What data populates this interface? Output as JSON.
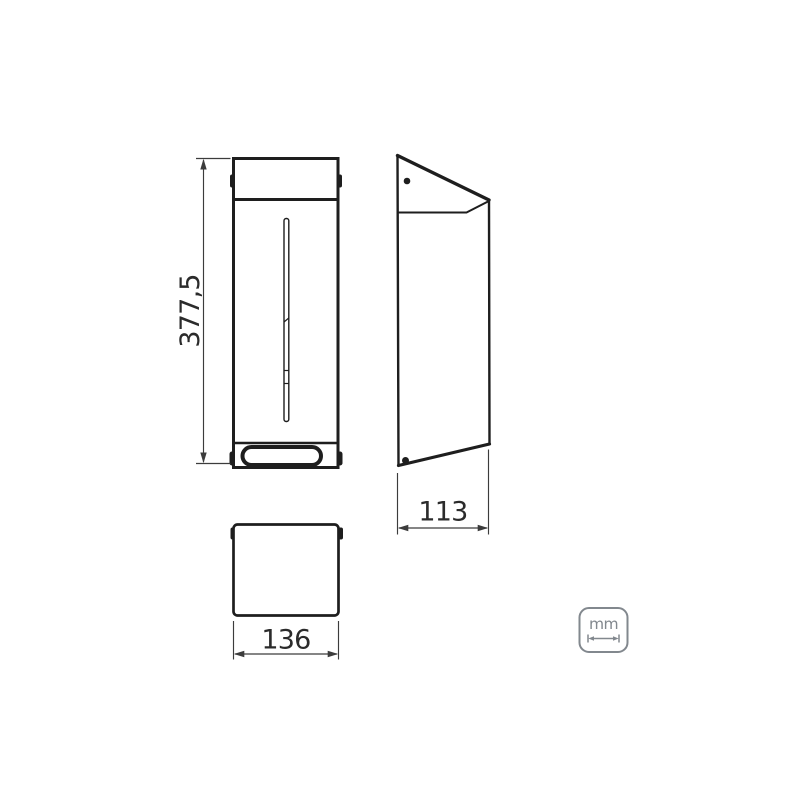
{
  "page": {
    "background": "#ffffff"
  },
  "colors": {
    "line": "#1e1e1e",
    "dim-line": "#3c3c3c",
    "dim-text": "#2b2b2b",
    "units-gray": "#82888e",
    "background": "#ffffff"
  },
  "dimensions": {
    "height": "377,5",
    "depth": "113",
    "width": "136"
  },
  "units": {
    "label": "mm"
  }
}
